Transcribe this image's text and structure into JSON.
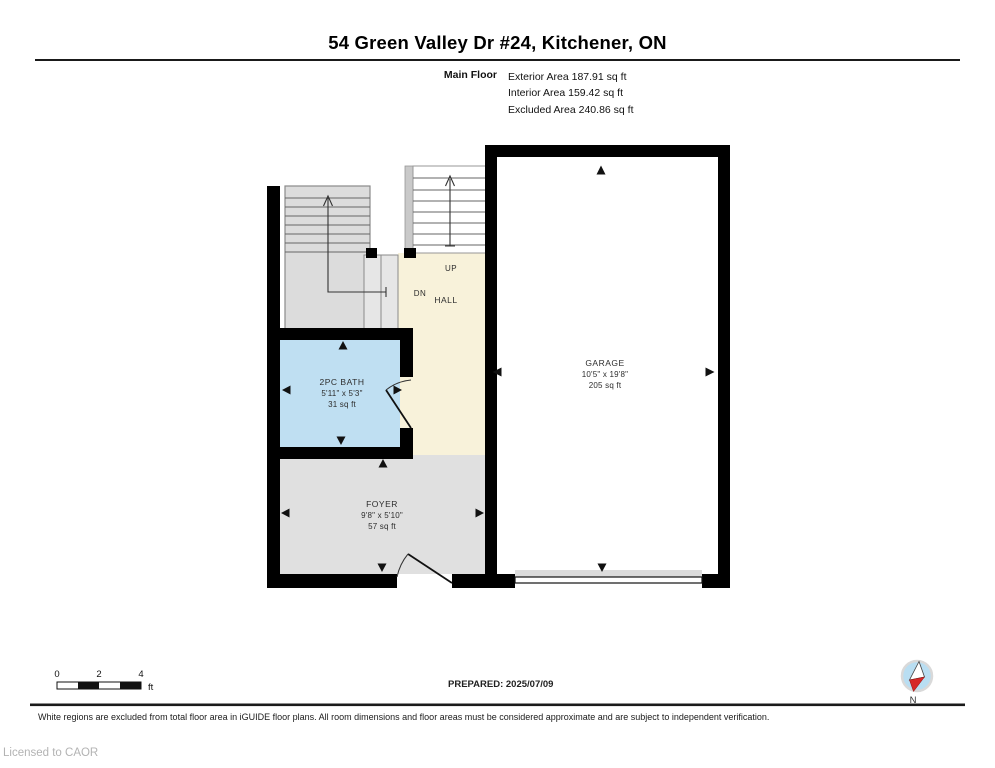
{
  "header": {
    "title": "54 Green Valley Dr #24, Kitchener, ON",
    "floor_label": "Main Floor",
    "stats": [
      "Exterior Area 187.91 sq ft",
      "Interior Area 159.42 sq ft",
      "Excluded Area 240.86 sq ft"
    ]
  },
  "floorplan": {
    "rooms": [
      {
        "id": "bath",
        "name": "2PC BATH",
        "dimensions": "5'11\" x 5'3\"",
        "area": "31 sq ft",
        "fill": "#bfdff2"
      },
      {
        "id": "hall",
        "name": "HALL",
        "fill": "#f8f2da"
      },
      {
        "id": "foyer",
        "name": "FOYER",
        "dimensions": "9'8\" x 5'10\"",
        "area": "57 sq ft",
        "fill": "#e0e0e0"
      },
      {
        "id": "garage",
        "name": "GARAGE",
        "dimensions": "10'5\" x 19'8\"",
        "area": "205 sq ft",
        "fill": "#ffffff"
      }
    ],
    "stairs": {
      "up_label": "UP",
      "down_label": "DN"
    },
    "wall_color": "#000000"
  },
  "footer": {
    "scale_bar": {
      "ticks": [
        "0",
        "2",
        "4"
      ],
      "unit": "ft"
    },
    "prepared": "PREPARED: 2025/07/09",
    "compass_label": "N",
    "disclaimer": "White regions are excluded from total floor area in iGUIDE floor plans. All room dimensions and floor areas must be considered approximate and are subject to independent verification.",
    "license": "Licensed to CAOR"
  }
}
